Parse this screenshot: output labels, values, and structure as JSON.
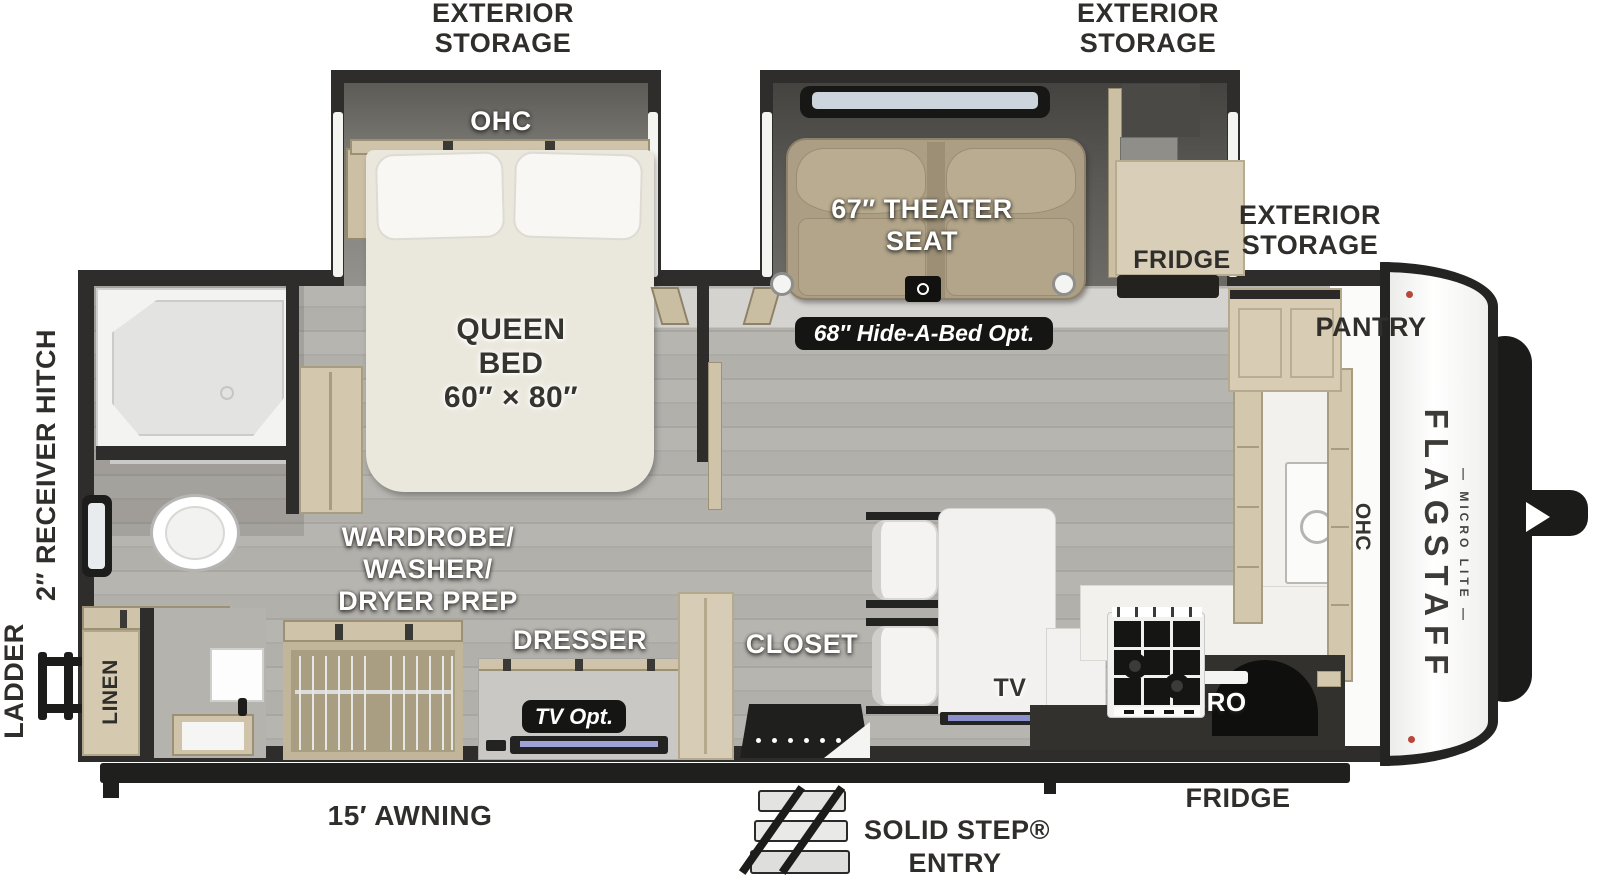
{
  "brand": {
    "name": "FLAGSTAFF",
    "tagline": "— MICRO LITE —"
  },
  "outside": {
    "storage_top_left": {
      "line1": "EXTERIOR",
      "line2": "STORAGE"
    },
    "storage_top_right": {
      "line1": "EXTERIOR",
      "line2": "STORAGE"
    },
    "storage_front": {
      "line1": "EXTERIOR",
      "line2": "STORAGE"
    },
    "receiver_hitch": "2″ RECEIVER HITCH",
    "ladder": "LADDER",
    "awning": "15′ AWNING",
    "entry": {
      "line1": "SOLID STEP®",
      "line2": "ENTRY"
    },
    "fridge": "FRIDGE",
    "pantry": "PANTRY"
  },
  "bedroom": {
    "ohc": "OHC",
    "bed": {
      "line1": "QUEEN",
      "line2": "BED",
      "line3": "60″ × 80″"
    },
    "wardrobe": {
      "line1": "WARDROBE/",
      "line2": "WASHER/",
      "line3": "DRYER PREP"
    },
    "dresser": "DRESSER",
    "tv_opt": "TV Opt.",
    "closet": "CLOSET"
  },
  "bathroom": {
    "linen": "LINEN"
  },
  "living": {
    "theater": {
      "line1": "67″ THEATER",
      "line2": "SEAT"
    },
    "hide_a_bed": "68″ Hide-A-Bed Opt.",
    "fridge_slide": "FRIDGE",
    "tv": "TV"
  },
  "kitchen": {
    "micro": "MICRO",
    "ohc": "OHC"
  },
  "colors": {
    "wall": "#2e2d2b",
    "floor": "#b4b2ad",
    "cabinet": "#d6cbb2",
    "theater_seat": "#b0a288",
    "badge": "#151514",
    "label": "#2f2e2b",
    "tv_screen": "#8b90cc",
    "carpet": "#d5d3cf"
  }
}
